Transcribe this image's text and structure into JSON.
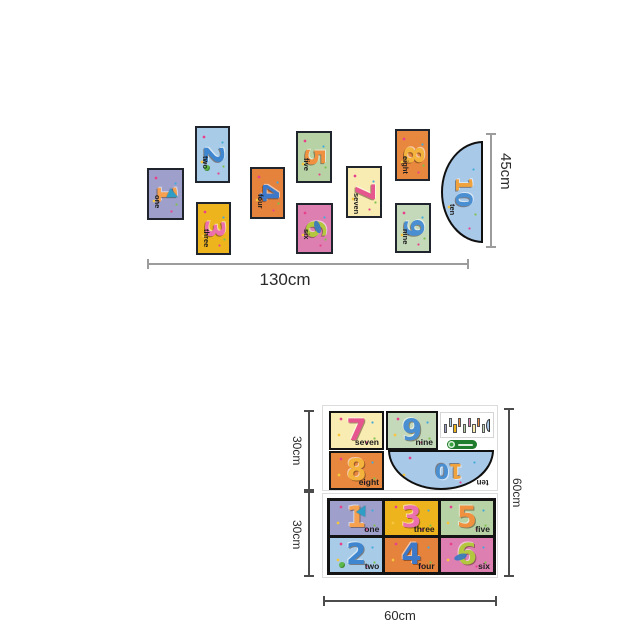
{
  "cards": {
    "one": {
      "numeral": "1",
      "word": "one",
      "bg": "#9e9fca",
      "number_color": "#f6a14f"
    },
    "two": {
      "numeral": "2",
      "word": "two",
      "bg": "#a8cbe7",
      "number_color": "#3e86cf"
    },
    "three": {
      "numeral": "3",
      "word": "three",
      "bg": "#eeb41e",
      "number_color": "#ec6fae"
    },
    "four": {
      "numeral": "4",
      "word": "four",
      "bg": "#e5823c",
      "number_color": "#3e78c9"
    },
    "five": {
      "numeral": "5",
      "word": "five",
      "bg": "#b7d2a5",
      "number_color": "#f0913f"
    },
    "six": {
      "numeral": "6",
      "word": "six",
      "bg": "#de7fb1",
      "number_color": "#b3c83e"
    },
    "seven": {
      "numeral": "7",
      "word": "seven",
      "bg": "#f8ecb2",
      "number_color": "#e7558e"
    },
    "eight": {
      "numeral": "8",
      "word": "eight",
      "bg": "#e8883e",
      "number_color": "#f3b33c"
    },
    "nine": {
      "numeral": "9",
      "word": "nine",
      "bg": "#c4d8ba",
      "number_color": "#4a8fd2"
    },
    "ten": {
      "word": "ten",
      "digit_1": "1",
      "digit_0": "0",
      "bg": "#a9c9e9",
      "digit1_color": "#f0a23c",
      "digit0_color": "#4a8fd2"
    }
  },
  "banner": {
    "width_label": "130cm",
    "height_label": "45cm"
  },
  "sheet_layout": {
    "row_top_label": "30cm",
    "row_bottom_label": "30cm",
    "height_label": "60cm",
    "width_label": "60cm"
  }
}
